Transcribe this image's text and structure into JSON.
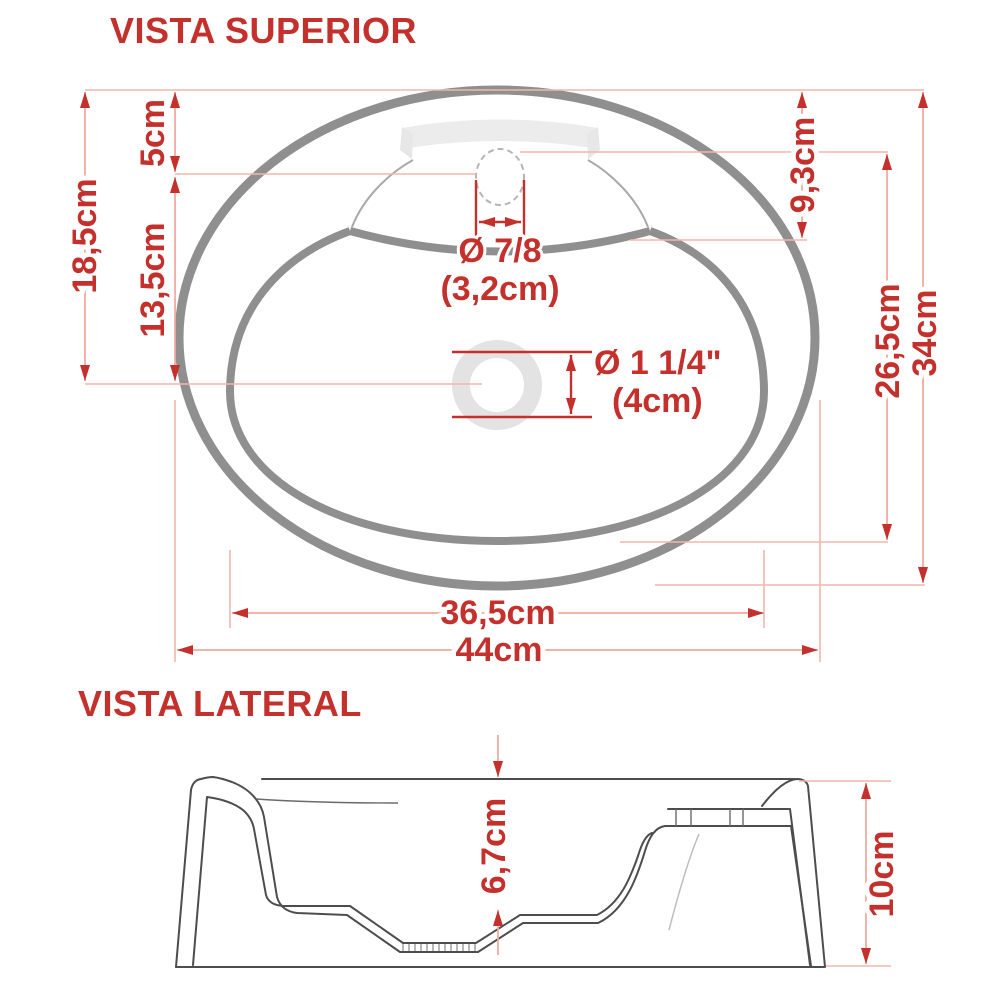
{
  "colors": {
    "dimension_red": "#c4302b",
    "extension_pink": "#f2b6ad",
    "drawing_gray": "#8f8f8f",
    "deck_light_gray": "#ececec",
    "profile_line": "#4d4d4d"
  },
  "top_view": {
    "title": "VISTA SUPERIOR",
    "dims": {
      "left_total": "18,5cm",
      "top_to_faucet": "5cm",
      "faucet_to_drain": "13,5cm",
      "top_to_basin_edge": "9,3cm",
      "basin_height": "26,5cm",
      "total_height": "34cm",
      "basin_width": "36,5cm",
      "total_width": "44cm",
      "faucet_hole_diameter": "Ø 7/8",
      "faucet_hole_diameter_cm": "(3,2cm)",
      "drain_hole_diameter": "Ø 1 1/4\"",
      "drain_hole_diameter_cm": "(4cm)"
    }
  },
  "side_view": {
    "title": "VISTA LATERAL",
    "dims": {
      "basin_depth": "6,7cm",
      "total_height": "10cm"
    }
  }
}
